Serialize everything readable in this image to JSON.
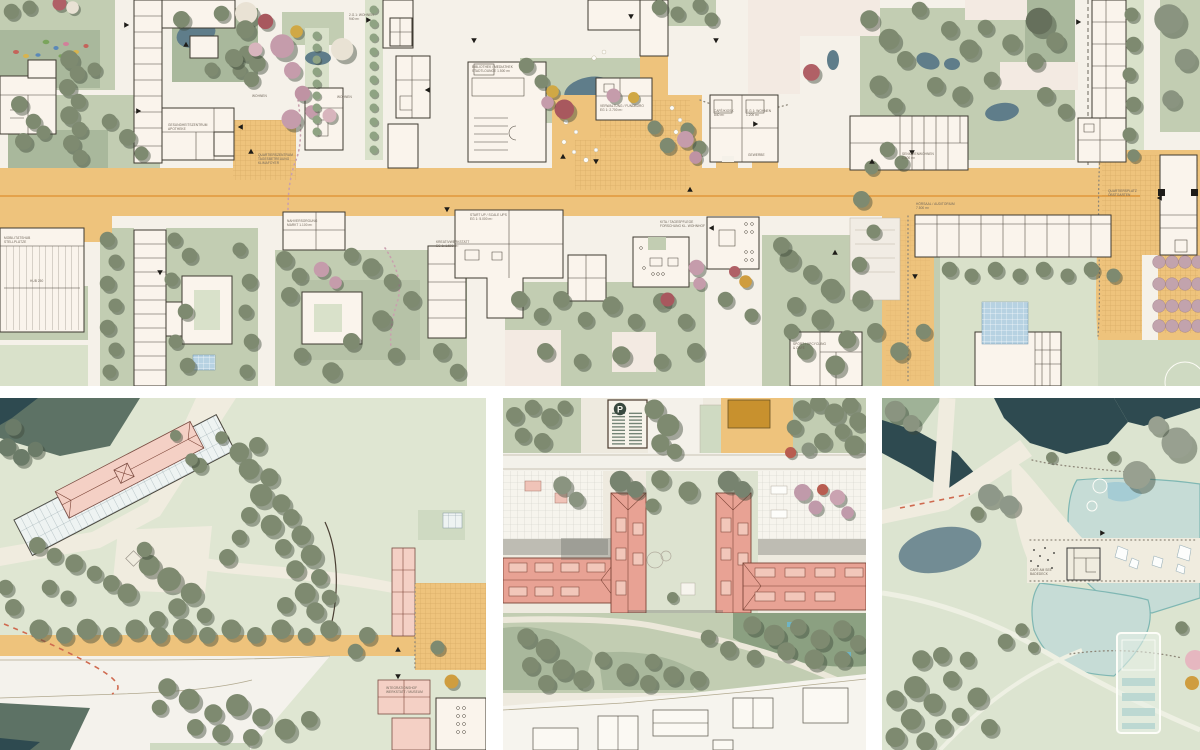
{
  "palette": {
    "street_orange": "#eec37c",
    "paper": "#f5f1e9",
    "sage_green": "#c2cdb2",
    "tree_green": "#7e8a70",
    "water_dark": "#2e4a50",
    "lake_teal": "#c6dcd6",
    "salmon_roof": "#e8a294",
    "pink_building": "#f4d0c5",
    "accent_mauve": "#c59cab",
    "accent_red": "#a8585e",
    "accent_yellow": "#d0a845",
    "dash_red": "#cf6a4f"
  },
  "master": {
    "labels": [
      {
        "t": "BIBLIOTHEK / MEDIATHEK",
        "t2": "STADTLOUNGE 1.500 m²"
      },
      {
        "t": "VERWALTUNG / FUNDBÜRO",
        "t2": "EG 1: 2.700 m²"
      },
      {
        "t": "CAFÉ/KIOSK",
        "t2": "840 m²"
      },
      {
        "t": "E.G.1: WOHNEN",
        "t2": "1.200 m²"
      },
      {
        "t": "GEWERBE"
      },
      {
        "t": "WOHNEN"
      },
      {
        "t": "WOHNEN"
      },
      {
        "t": "2.G.1: WOHNEN",
        "t2": "940 m²"
      },
      {
        "t": "GESUNDHEITSZENTRUM",
        "t2": "APOTHEKE"
      },
      {
        "t": "QUARTIERSZENTRUM",
        "t2": "TAGESBETREUUNG",
        "t3": "KLIMAFOYER"
      },
      {
        "t": "START UP / SCALE UPS",
        "t2": "EG 1: 5.000 m²"
      },
      {
        "t": "KREATIVWERKSTATT",
        "t2": "EG 1: 1.500 m²"
      },
      {
        "t": "KITA / TAGESPFLEGE",
        "t2": "FORSCHUNG KL. WOHNHOF"
      },
      {
        "t": "HÖRSAAL / AUDITORIUM",
        "t2": "7.500 m²"
      },
      {
        "t": "SENIORENWOHNEN",
        "t2": "1.400 m²"
      },
      {
        "t": "QUARTIERSPLATZ",
        "t2": "OBSTGARTEN"
      },
      {
        "t": "MOBILITÄTSHUB",
        "t2": "STELLPLÄTZE"
      },
      {
        "t": "HUB 250"
      },
      {
        "t": "NAHVERSORGUNG",
        "t2": "MARKT 1.100 m²"
      },
      {
        "t": "SPORT / UPCYCLING",
        "t2": "& CAFÉ"
      }
    ]
  },
  "park": {
    "labels": [
      {
        "t": "INTEGRATIONSHOF",
        "t2": "WERKSTATT / MUSEUM"
      }
    ]
  },
  "courtyard": {
    "labels": [
      {
        "t": "P"
      }
    ]
  },
  "lake": {
    "labels": [
      {
        "t": "CAFÉ AM SEE",
        "t2": "BADEDECK"
      }
    ]
  }
}
